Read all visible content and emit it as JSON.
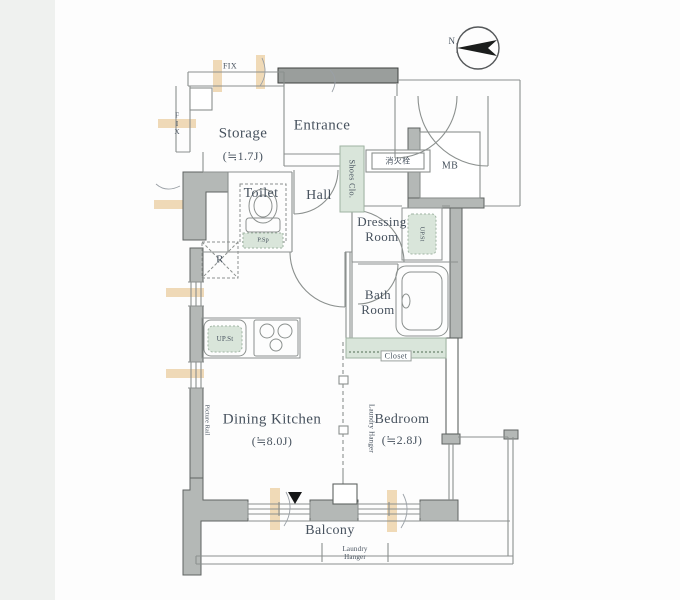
{
  "plan": {
    "compass_north": "N",
    "window_labels": {
      "fix_top": "FIX",
      "fix_left": "FIX"
    },
    "rooms": {
      "storage": {
        "name": "Storage",
        "size": "(≒1.7J)"
      },
      "entrance": {
        "name": "Entrance"
      },
      "toilet": {
        "name": "Toilet"
      },
      "hall": {
        "name": "Hall"
      },
      "dressing_room": {
        "name": "Dressing Room"
      },
      "bath_room": {
        "name": "Bath Room"
      },
      "dining_kitchen": {
        "name": "Dining Kitchen",
        "size": "(≒8.0J)"
      },
      "bedroom": {
        "name": "Bedroom",
        "size": "(≒2.8J)"
      },
      "balcony": {
        "name": "Balcony"
      }
    },
    "features": {
      "shoes_closet": "Shoes Clo.",
      "fire_hydrant": "消火栓",
      "meter_box": "MB",
      "toilet_pipe_space": "P.Sp",
      "washer_upper_storage": "UP.St",
      "kitchen_upper_storage": "UP.St",
      "refrigerator_mark": "R",
      "closet": "Closet",
      "bedroom_laundry_hanger": "Laundry Hanger",
      "balcony_laundry_hanger": "Laundry Hanger",
      "picture_rail": "Picture Rail"
    },
    "colors": {
      "wall_fill": "#b4b8b6",
      "dark_wall": "#9a9e9c",
      "fixture_green": "#d9e5da",
      "window_highlight": "#e5bd7e",
      "label_text": "#47525e",
      "background": "#ffffff",
      "margin_band": "#eff1ef"
    }
  }
}
